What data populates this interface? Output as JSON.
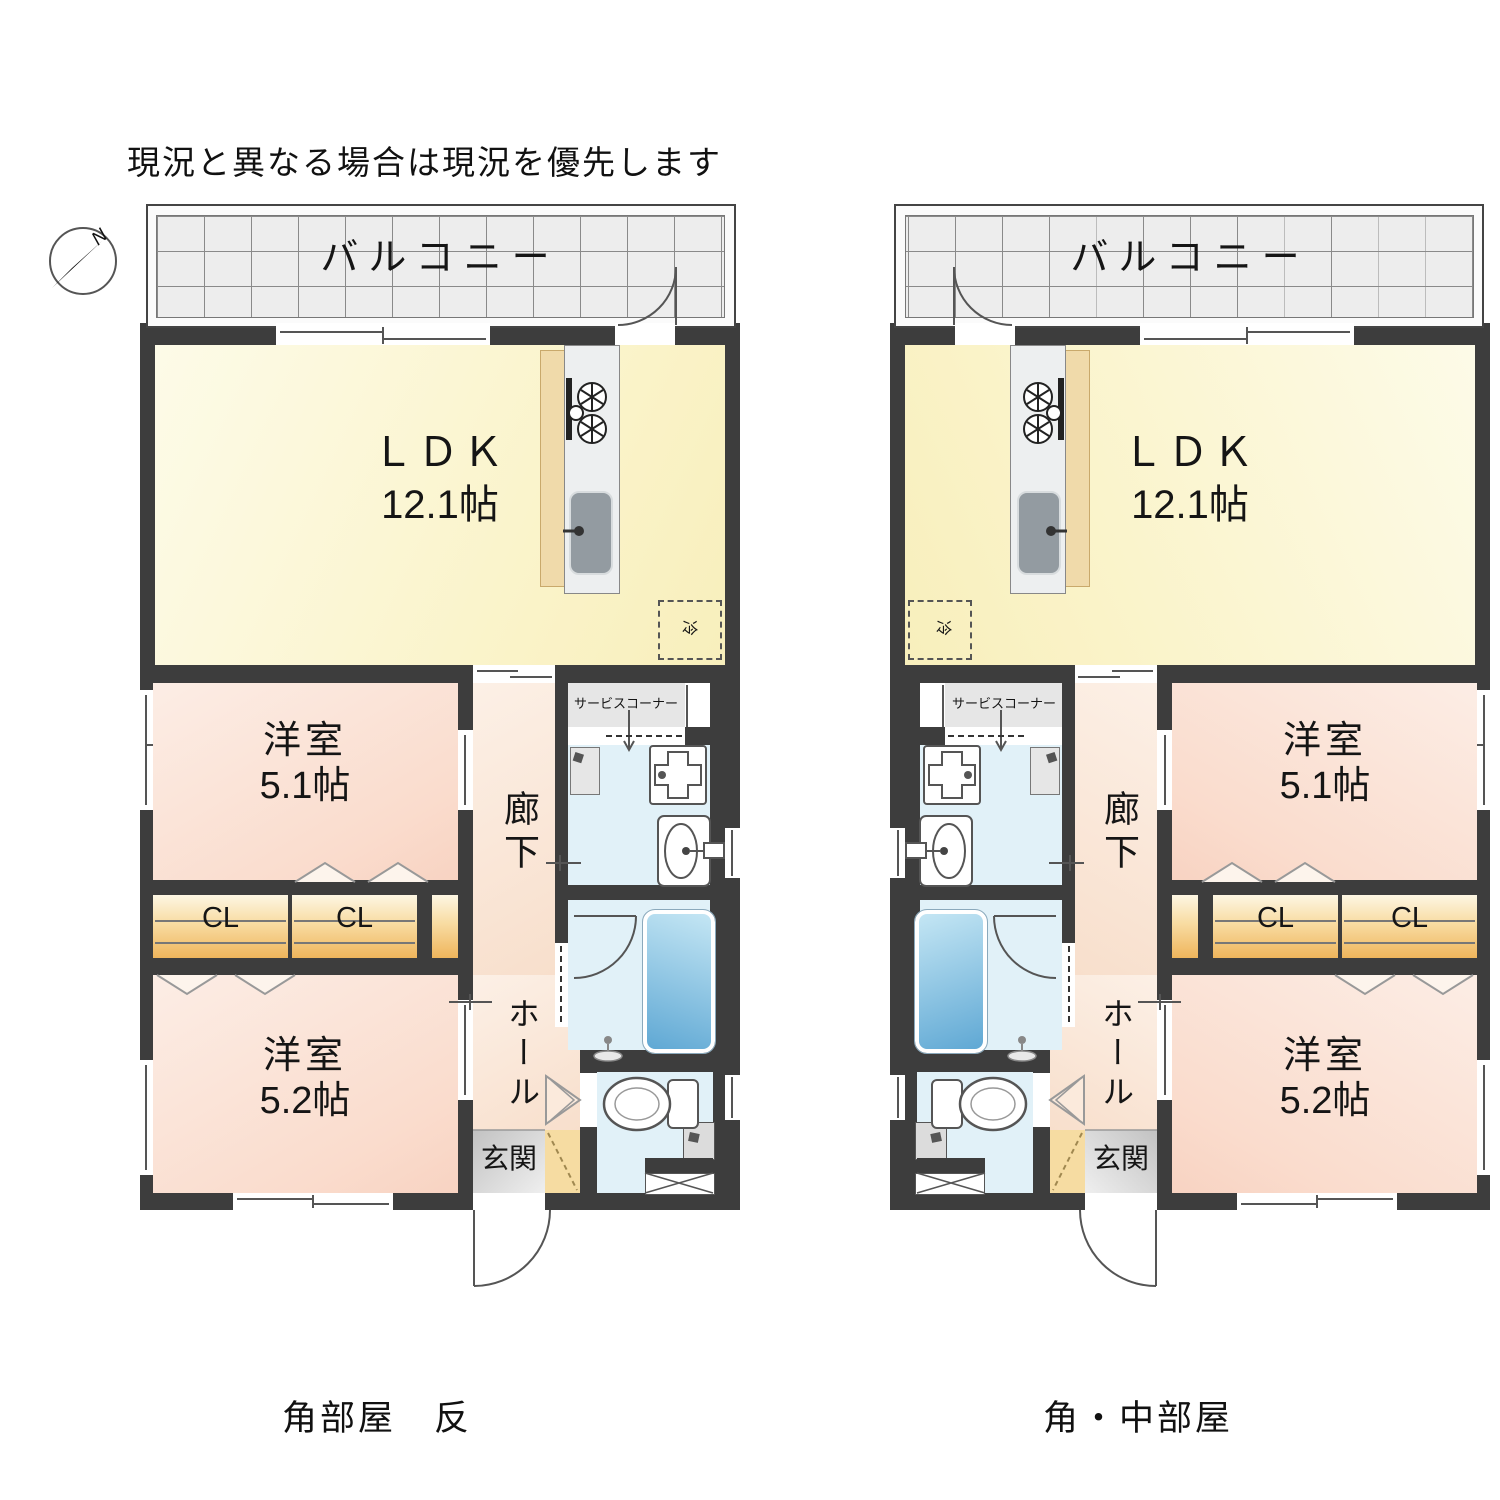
{
  "note": "現況と異なる場合は現況を優先します",
  "compass": {
    "north_label": "N"
  },
  "plans": [
    {
      "caption": "角部屋　反",
      "balcony_label": "バルコニー",
      "ldk_label": "ＬＤＫ",
      "ldk_size": "12.1帖",
      "bedroom1_label": "洋室",
      "bedroom1_size": "5.1帖",
      "bedroom2_label": "洋室",
      "bedroom2_size": "5.2帖",
      "closet1_label": "CL",
      "closet2_label": "CL",
      "corridor_label": "廊下",
      "hall_label": "ホール",
      "entrance_label": "玄関",
      "service_corner_label": "サービスコーナー",
      "refrigerator_label": "冷"
    },
    {
      "caption": "角・中部屋",
      "balcony_label": "バルコニー",
      "ldk_label": "ＬＤＫ",
      "ldk_size": "12.1帖",
      "bedroom1_label": "洋室",
      "bedroom1_size": "5.1帖",
      "bedroom2_label": "洋室",
      "bedroom2_size": "5.2帖",
      "closet1_label": "CL",
      "closet2_label": "CL",
      "corridor_label": "廊下",
      "hall_label": "ホール",
      "entrance_label": "玄関",
      "service_corner_label": "サービスコーナー",
      "refrigerator_label": "冷"
    }
  ]
}
